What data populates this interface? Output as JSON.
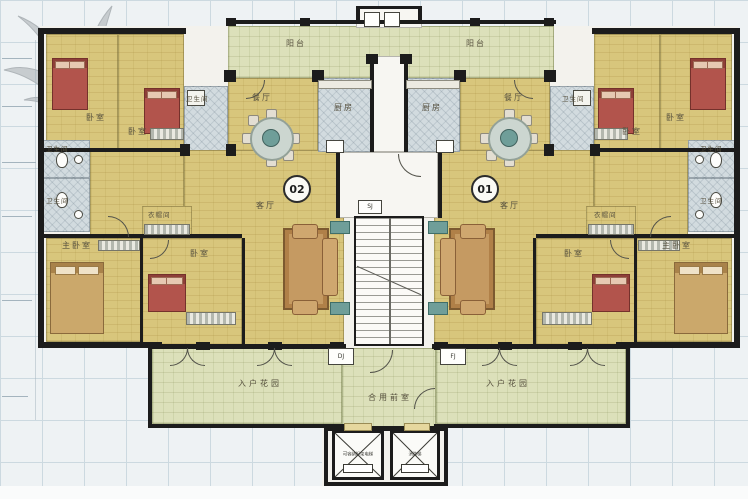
{
  "units": {
    "left": {
      "number": "02",
      "balcony": "阳台",
      "dining": "餐厅",
      "kitchen": "厨房",
      "living": "客厅",
      "bedroom_top_outer": "卧室",
      "bedroom_top_inner": "卧室",
      "bath_inner": "卫生间",
      "bath_edge_upper": "卫生间",
      "bath_edge_lower": "卫生间",
      "master_bedroom": "主卧室",
      "bedroom_bottom": "卧室",
      "cloakroom": "衣帽间",
      "entry_garden": "入户花园"
    },
    "right": {
      "number": "01",
      "balcony": "阳台",
      "dining": "餐厅",
      "kitchen": "厨房",
      "living": "客厅",
      "bedroom_top_outer": "卧室",
      "bedroom_top_inner": "卧室",
      "bath_inner": "卫生间",
      "bath_edge_upper": "卫生间",
      "bath_edge_lower": "卫生间",
      "master_bedroom": "主卧室",
      "bedroom_bottom": "卧室",
      "cloakroom": "衣帽间",
      "entry_garden": "入户花园"
    }
  },
  "core": {
    "shared_vestibule": "合用前室",
    "duct_left": "DJ",
    "duct_right": "FJ",
    "shaft_box": "SJ",
    "elevator_left": "可容纳担架电梯",
    "elevator_right": "消防梯"
  },
  "colors": {
    "wall": "#1c1c1c",
    "floor_wood": "#d8c67c",
    "floor_garden": "#dce0ba",
    "floor_tile": "#d2dbdf",
    "bed": "#b2544c",
    "furniture_wood": "#c9a06a",
    "accent_teal": "#6f9e99",
    "grid_line": "#ccd9e0"
  }
}
